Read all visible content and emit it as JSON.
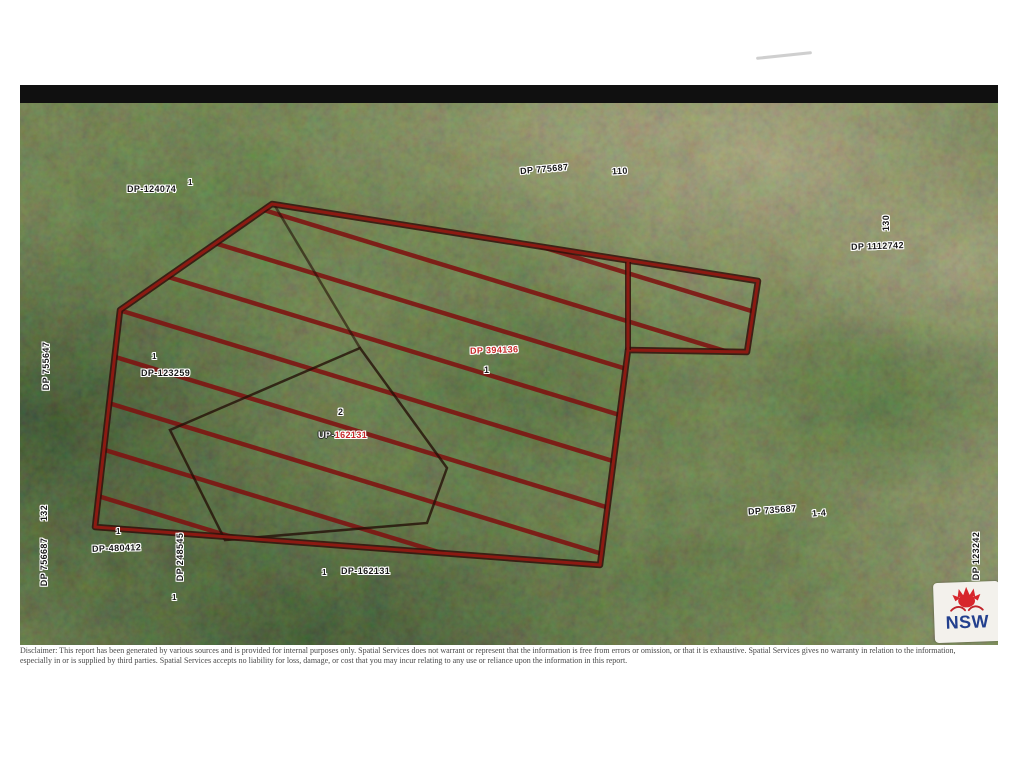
{
  "report": {
    "logo_text": "NSW",
    "disclaimer": "Disclaimer: This report has been generated by various sources and is provided for internal purposes only. Spatial Services does not warrant or represent that the information is free from errors or omission, or that it is exhaustive. Spatial Services gives no warranty in relation to the information, especially in or is supplied by third parties. Spatial Services accepts no liability for loss, damage, or cost that you may incur relating to any use or reliance upon the information in this report.",
    "colors": {
      "boundary_red": "#8c1a12",
      "boundary_dark": "#30100a",
      "hatch_red": "#7e1210",
      "label_red": "#c62828",
      "logo_blue": "#23408e",
      "logo_red": "#d7262c",
      "topbar_black": "#101010"
    }
  },
  "map": {
    "labels": [
      {
        "id": "dp124074",
        "text": "DP-124074",
        "lot": "1"
      },
      {
        "id": "dp775687",
        "text": "DP 775687",
        "lot": "110"
      },
      {
        "id": "dp1112742",
        "text": "DP 1112742",
        "lot": "130"
      },
      {
        "id": "dp123259",
        "text": "DP-123259",
        "lot": "1"
      },
      {
        "id": "dp394136",
        "text": "DP 394136",
        "lot": "1"
      },
      {
        "id": "up162131",
        "prefix": "UP-",
        "number": "162131",
        "lot": "2"
      },
      {
        "id": "dp162131",
        "text": "DP-162131",
        "lot": "1"
      },
      {
        "id": "dp480412",
        "text": "DP-480412",
        "lot": "1"
      },
      {
        "id": "dp248545",
        "text": "DP 248545",
        "lot": "1"
      },
      {
        "id": "dp755647",
        "text": "DP 755647"
      },
      {
        "id": "dp756687",
        "text": "DP 756687",
        "lot": "132"
      },
      {
        "id": "dp735687",
        "text": "DP 735687",
        "lot": "1-4"
      },
      {
        "id": "dp123242",
        "text": "DP 123242"
      }
    ]
  }
}
